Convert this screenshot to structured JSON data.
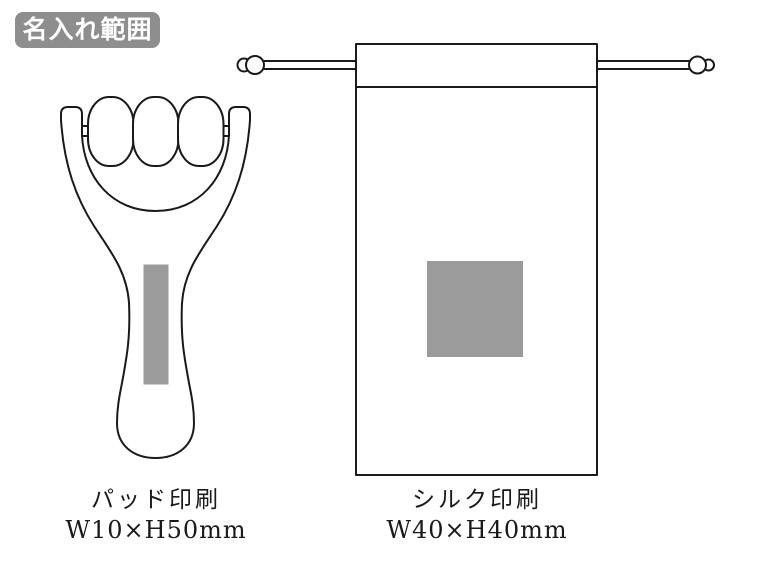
{
  "page": {
    "background_color": "#ffffff",
    "outline_color": "#1a1a1a"
  },
  "badge": {
    "label": "名入れ範囲",
    "background_color": "#8e8e8e",
    "text_color": "#ffffff"
  },
  "products": {
    "roller": {
      "print_method": "パッド印刷",
      "print_size": "W10×H50mm",
      "print_area_color": "#9b9b9b"
    },
    "pouch": {
      "print_method": "シルク印刷",
      "print_size": "W40×H40mm",
      "print_area_color": "#9b9b9b"
    }
  }
}
